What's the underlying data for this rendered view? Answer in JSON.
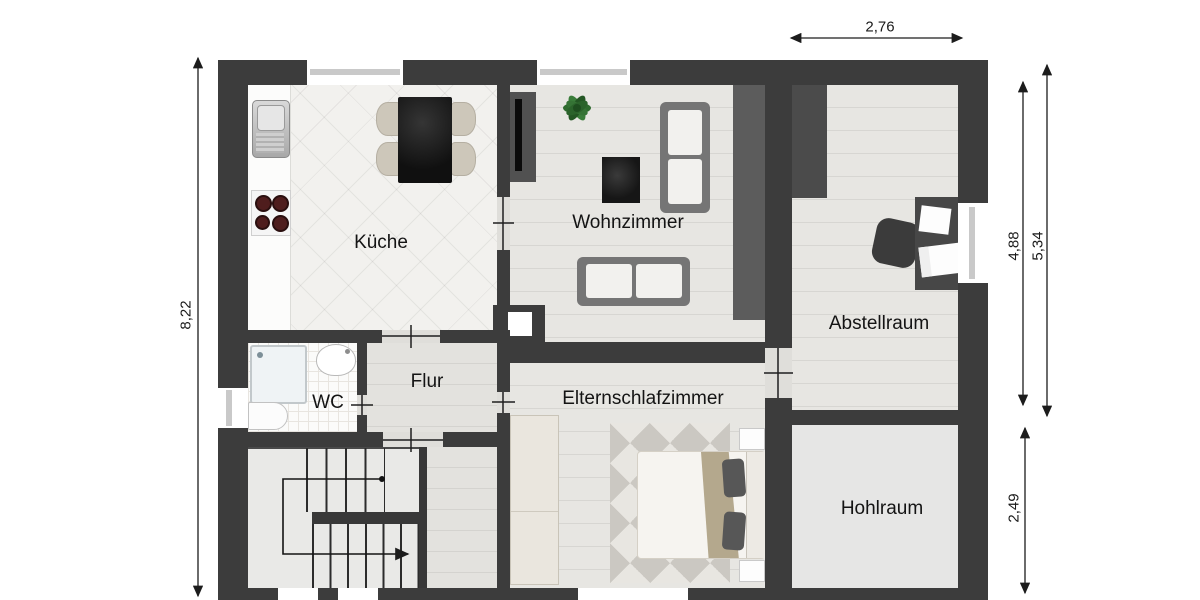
{
  "rooms": [
    {
      "id": "kueche",
      "label": "Küche"
    },
    {
      "id": "wohnzimmer",
      "label": "Wohnzimmer"
    },
    {
      "id": "abstellraum",
      "label": "Abstellraum"
    },
    {
      "id": "flur",
      "label": "Flur"
    },
    {
      "id": "wc",
      "label": "WC"
    },
    {
      "id": "elternschlafzimmer",
      "label": "Elternschlafzimmer"
    },
    {
      "id": "hohlraum",
      "label": "Hohlraum"
    }
  ],
  "dimensions": {
    "top": "2,76",
    "left": "8,22",
    "right_inner": "4,88",
    "right_outer": "5,34",
    "right_bottom": "2,49"
  },
  "fixtures": [
    "kitchen-sink",
    "stove-cooktop",
    "dining-table",
    "dining-chair",
    "tv-sideboard",
    "plant",
    "coffee-table",
    "sofa",
    "wall-unit",
    "storage-closet",
    "desk",
    "office-chair",
    "shower",
    "washbasin",
    "toilet",
    "wardrobe",
    "double-bed",
    "pillow",
    "nightstand",
    "rug",
    "staircase"
  ],
  "colors": {
    "wall": "#3c3c3c",
    "floor_light": "#e4e3df",
    "plant_green": "#2f6b2f",
    "blanket_tan": "#b4a88d",
    "burner_red": "#4f1d1d"
  }
}
